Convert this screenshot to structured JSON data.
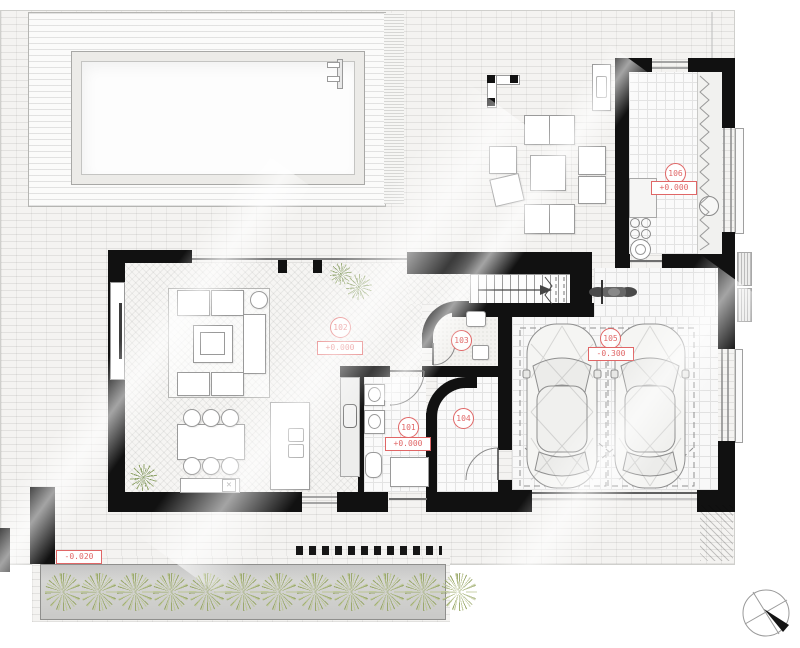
{
  "drawing": {
    "type": "residential ground floor plan",
    "site_elevation_label": "-0.020",
    "rooms": [
      {
        "number": "101",
        "elevation": "+0.000"
      },
      {
        "number": "102",
        "elevation": "+0.000"
      },
      {
        "number": "103",
        "elevation": ""
      },
      {
        "number": "104",
        "elevation": ""
      },
      {
        "number": "105",
        "elevation": "-0.300"
      },
      {
        "number": "106",
        "elevation": "+0.000"
      }
    ],
    "colors": {
      "wall": "#111111",
      "label_red": "#e06666",
      "plant_green": "#96a564",
      "tile_line": "#e1e1e1",
      "brick_bg": "#f4f3f1"
    },
    "planter": {
      "plant_count": 12
    },
    "symbols": [
      "north-arrow",
      "stair-direction-arrow",
      "two-cars",
      "motorcycle",
      "pool-ladder"
    ]
  }
}
